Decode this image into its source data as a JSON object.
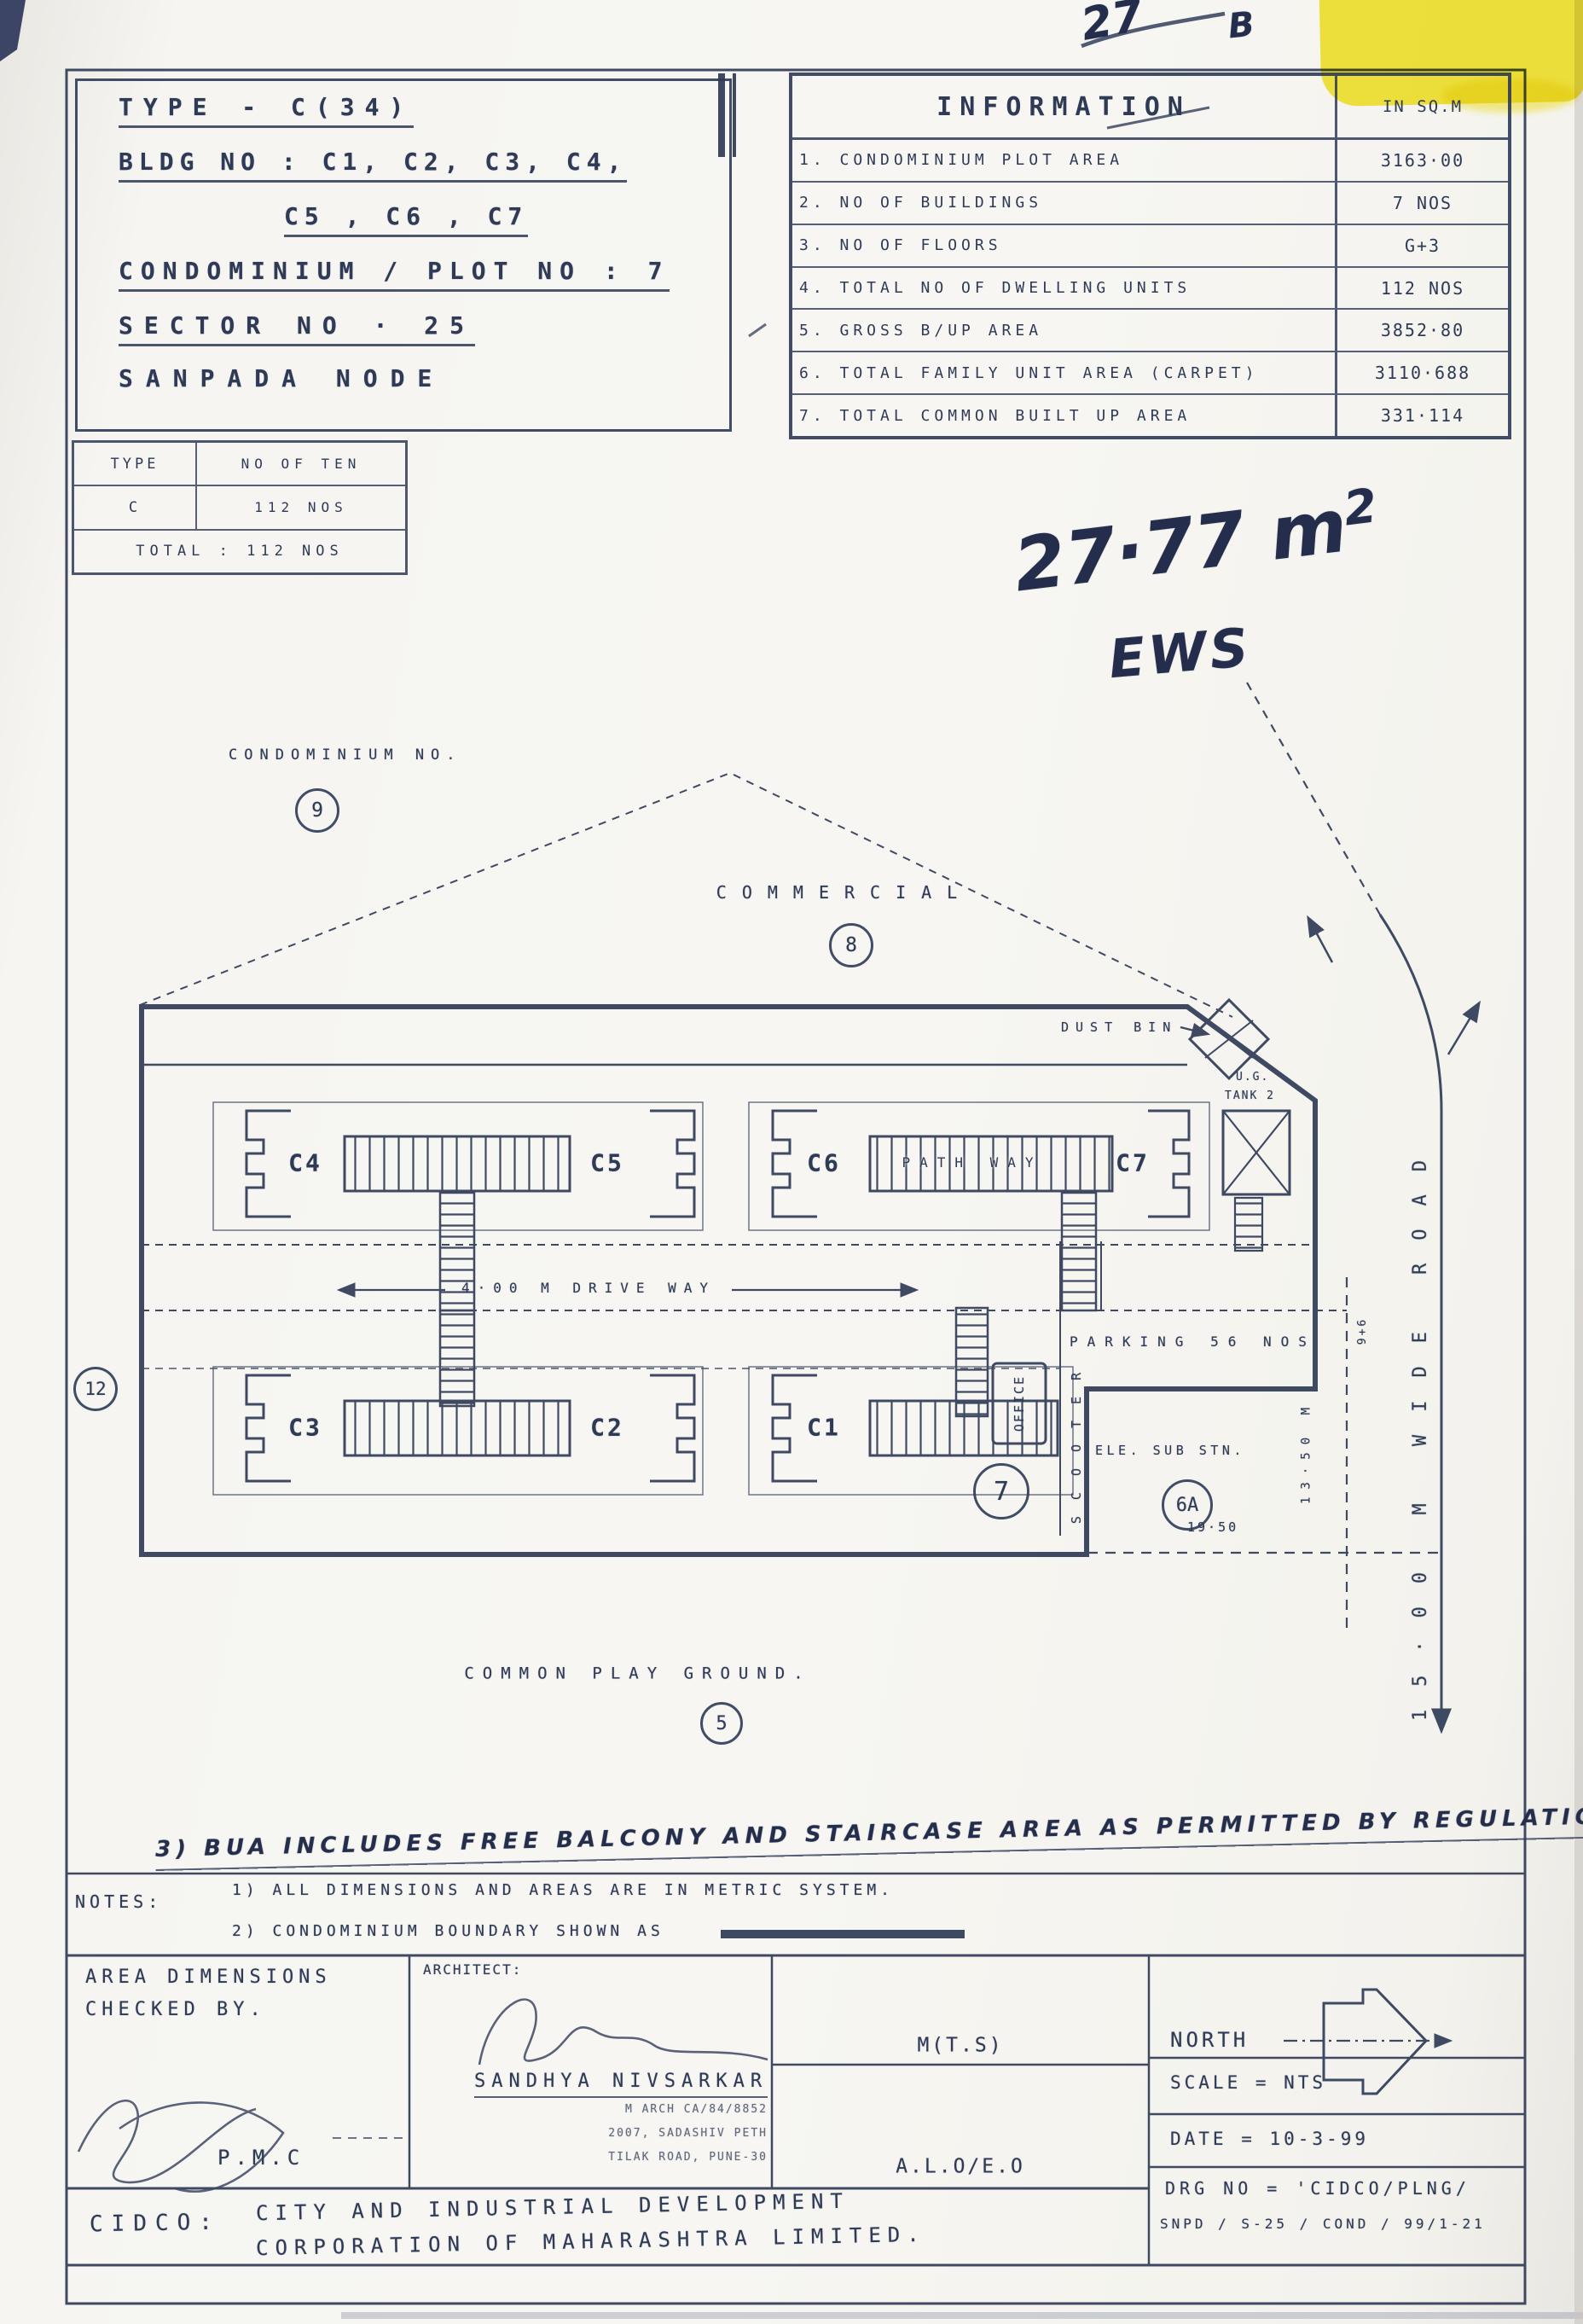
{
  "annotations": {
    "corner_note": "27",
    "corner_note_b": "B",
    "area_note": "27·77 m",
    "area_note_sup": "2",
    "ews": "EWS",
    "regulation_note": "3) BUA INCLUDES FREE BALCONY AND STAIRCASE AREA AS PERMITTED BY REGULATIONS."
  },
  "title_block": {
    "type_line": "TYPE - C(34)",
    "bldg_line1": "BLDG NO : C1, C2, C3, C4,",
    "bldg_line2": "C5 , C6 , C7",
    "plot_line": "CONDOMINIUM / PLOT NO : 7",
    "sector_line": "SECTOR NO · 25",
    "node_line": "SANPADA NODE"
  },
  "information": {
    "title": "INFORMATION",
    "unit": "IN SQ.M",
    "rows": [
      {
        "label": "1. CONDOMINIUM PLOT AREA",
        "value": "3163·00"
      },
      {
        "label": "2. NO OF BUILDINGS",
        "value": "7 NOS"
      },
      {
        "label": "3. NO OF FLOORS",
        "value": "G+3"
      },
      {
        "label": "4. TOTAL NO OF DWELLING UNITS",
        "value": "112 NOS"
      },
      {
        "label": "5. GROSS B/UP AREA",
        "value": "3852·80"
      },
      {
        "label": "6. TOTAL FAMILY UNIT AREA (CARPET)",
        "value": "3110·688"
      },
      {
        "label": "7. TOTAL COMMON BUILT UP AREA",
        "value": "331·114"
      }
    ]
  },
  "tenement_table": {
    "col1_header": "TYPE",
    "col2_header": "NO OF TEN",
    "row_type": "C",
    "row_count": "112 NOS",
    "total": "TOTAL : 112 NOS"
  },
  "site_plan": {
    "condominium_label": "CONDOMINIUM NO.",
    "condominium_circle": "9",
    "commercial_label": "COMMERCIAL",
    "commercial_circle": "8",
    "dust_bin": "DUST BIN",
    "ug_tank_line1": "U.G.",
    "ug_tank_line2": "TANK 2",
    "buildings": {
      "c1": "C1",
      "c2": "C2",
      "c3": "C3",
      "c4": "C4",
      "c5": "C5",
      "c6": "C6",
      "c7": "C7"
    },
    "path_way": "PATH WAY",
    "drive_way": "4·00 M DRIVE WAY",
    "office": "OFFICE",
    "scooter": "SCOOTER",
    "parking": "PARKING 56 NOS",
    "plot_circle": "7",
    "ele_sub_stn": "ELE. SUB STN.",
    "sub_stn_circle": "6A",
    "dim_bottom": "19·50",
    "dim_right": "13·50 M",
    "dim_corner": "9+6",
    "road_label": "15·00 M WIDE ROAD",
    "adjacent_circle": "12",
    "play_ground_label": "COMMON PLAY GROUND.",
    "play_ground_circle": "5"
  },
  "notes": {
    "label": "NOTES:",
    "note1": "1) ALL DIMENSIONS AND AREAS ARE IN METRIC SYSTEM.",
    "note2": "2) CONDOMINIUM BOUNDARY SHOWN AS"
  },
  "footer": {
    "checked_by_line1": "AREA DIMENSIONS",
    "checked_by_line2": "CHECKED BY.",
    "checked_by_org": "P.M.C",
    "architect_label": "ARCHITECT:",
    "architect_name": "SANDHYA NIVSARKAR",
    "architect_reg": "M ARCH CA/84/8852",
    "architect_addr1": "2007, SADASHIV PETH",
    "architect_addr2": "TILAK ROAD, PUNE-30",
    "authority1": "M(T.S)",
    "authority2": "A.L.O/E.O",
    "north_label": "NORTH",
    "scale": "SCALE = NTS",
    "date": "DATE = 10-3-99",
    "drg_no_line1": "DRG NO = 'CIDCO/PLNG/",
    "drg_no_line2": "SNPD / S-25 / COND / 99/1-21",
    "org_abbr": "CIDCO:",
    "org_line1": "CITY AND INDUSTRIAL DEVELOPMENT",
    "org_line2": "CORPORATION OF MAHARASHTRA LIMITED."
  }
}
